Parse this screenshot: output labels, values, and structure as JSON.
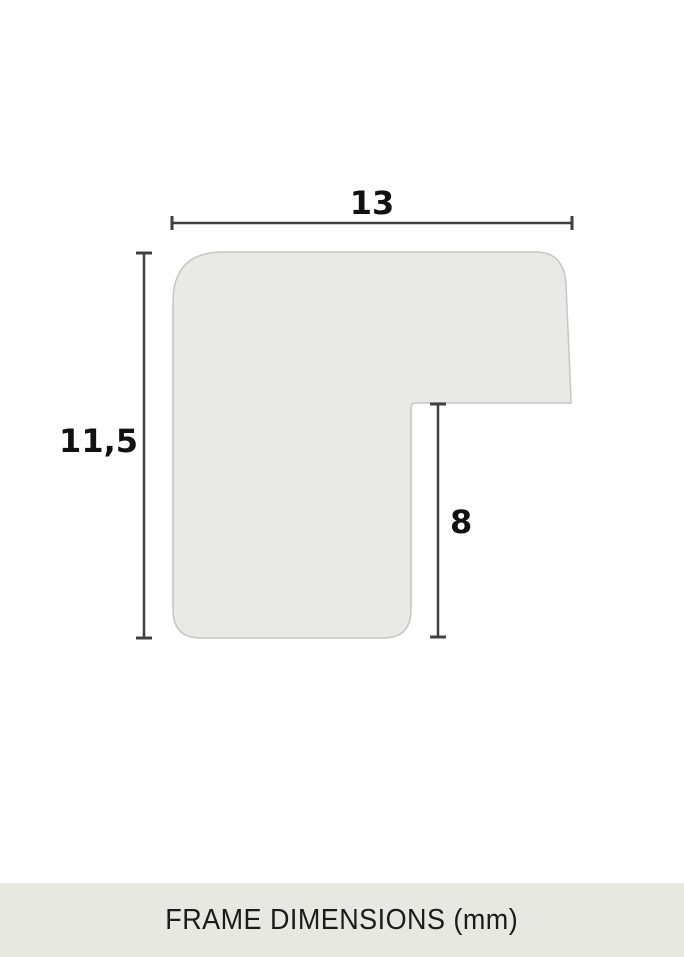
{
  "diagram": {
    "type": "frame-profile-cross-section",
    "unit": "mm",
    "labels": {
      "width": "13",
      "height": "11,5",
      "rabbet_depth": "8"
    },
    "colors": {
      "shape_fill": "#e9e9e5",
      "shape_stroke": "#c6c6c2",
      "dimension_line": "#404040",
      "label_text": "#111111"
    }
  },
  "footer": {
    "title": "FRAME DIMENSIONS (mm)",
    "background": "#e8e8e3",
    "text_color": "#1b1b1b"
  },
  "page": {
    "background": "#ffffff"
  }
}
